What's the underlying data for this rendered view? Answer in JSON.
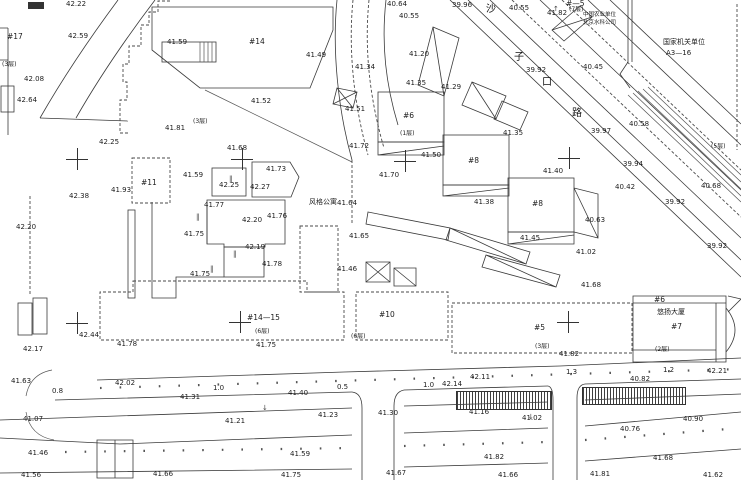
{
  "meta": {
    "app": "cadastral-survey-map",
    "background": "#ffffff",
    "ink_color": "#1c1c1c",
    "canvas": {
      "width": 741,
      "height": 480
    }
  },
  "map": {
    "street_name_chars": [
      "沙",
      "子",
      "口",
      "路"
    ],
    "labels": [
      {
        "t": "42.22",
        "x": 66,
        "y": 1
      },
      {
        "t": "42.59",
        "x": 68,
        "y": 33
      },
      {
        "t": "42.08",
        "x": 24,
        "y": 76
      },
      {
        "t": "42.64",
        "x": 17,
        "y": 97
      },
      {
        "t": "42.25",
        "x": 99,
        "y": 139
      },
      {
        "t": "41.59",
        "x": 167,
        "y": 39
      },
      {
        "t": "41.81",
        "x": 165,
        "y": 125
      },
      {
        "t": "41.68",
        "x": 227,
        "y": 145
      },
      {
        "t": "41.73",
        "x": 266,
        "y": 166
      },
      {
        "t": "41.49",
        "x": 306,
        "y": 52
      },
      {
        "t": "41.52",
        "x": 251,
        "y": 98
      },
      {
        "t": "41.51",
        "x": 345,
        "y": 106
      },
      {
        "t": "41.20",
        "x": 409,
        "y": 51
      },
      {
        "t": "40.64",
        "x": 387,
        "y": 1
      },
      {
        "t": "40.55",
        "x": 399,
        "y": 13
      },
      {
        "t": "39.96",
        "x": 452,
        "y": 2
      },
      {
        "t": "41.34",
        "x": 355,
        "y": 64
      },
      {
        "t": "40.55",
        "x": 509,
        "y": 5
      },
      {
        "t": "41.82",
        "x": 547,
        "y": 10
      },
      {
        "t": "39.92",
        "x": 526,
        "y": 67
      },
      {
        "t": "40.45",
        "x": 583,
        "y": 64
      },
      {
        "t": "40.58",
        "x": 629,
        "y": 121
      },
      {
        "t": "39.97",
        "x": 591,
        "y": 128
      },
      {
        "t": "39.94",
        "x": 623,
        "y": 161
      },
      {
        "t": "40.42",
        "x": 615,
        "y": 184
      },
      {
        "t": "40.68",
        "x": 701,
        "y": 183
      },
      {
        "t": "39.92",
        "x": 665,
        "y": 199
      },
      {
        "t": "39.92",
        "x": 707,
        "y": 243
      },
      {
        "t": "40.63",
        "x": 585,
        "y": 217
      },
      {
        "t": "41.35",
        "x": 406,
        "y": 80
      },
      {
        "t": "41.29",
        "x": 441,
        "y": 84
      },
      {
        "t": "41.35",
        "x": 503,
        "y": 130
      },
      {
        "t": "41.50",
        "x": 421,
        "y": 152
      },
      {
        "t": "41.70",
        "x": 379,
        "y": 172
      },
      {
        "t": "41.40",
        "x": 543,
        "y": 168
      },
      {
        "t": "41.38",
        "x": 474,
        "y": 199
      },
      {
        "t": "41.45",
        "x": 520,
        "y": 235
      },
      {
        "t": "41.02",
        "x": 576,
        "y": 249
      },
      {
        "t": "41.68",
        "x": 581,
        "y": 282
      },
      {
        "t": "41.72",
        "x": 349,
        "y": 143
      },
      {
        "t": "41.93",
        "x": 111,
        "y": 187
      },
      {
        "t": "42.38",
        "x": 69,
        "y": 193
      },
      {
        "t": "42.20",
        "x": 16,
        "y": 224
      },
      {
        "t": "41.59",
        "x": 183,
        "y": 172
      },
      {
        "t": "42.25",
        "x": 219,
        "y": 182
      },
      {
        "t": "42.27",
        "x": 250,
        "y": 184
      },
      {
        "t": "41.77",
        "x": 204,
        "y": 202
      },
      {
        "t": "42.20",
        "x": 242,
        "y": 217
      },
      {
        "t": "41.76",
        "x": 267,
        "y": 213
      },
      {
        "t": "41.75",
        "x": 184,
        "y": 231
      },
      {
        "t": "42.19",
        "x": 245,
        "y": 244
      },
      {
        "t": "41.78",
        "x": 262,
        "y": 261
      },
      {
        "t": "41.75",
        "x": 190,
        "y": 271
      },
      {
        "t": "41.64",
        "x": 337,
        "y": 200
      },
      {
        "t": "41.65",
        "x": 349,
        "y": 233
      },
      {
        "t": "41.46",
        "x": 337,
        "y": 266
      },
      {
        "t": "41.75",
        "x": 256,
        "y": 342
      },
      {
        "t": "41.78",
        "x": 117,
        "y": 341
      },
      {
        "t": "42.44",
        "x": 79,
        "y": 332
      },
      {
        "t": "42.17",
        "x": 23,
        "y": 346
      },
      {
        "t": "41.63",
        "x": 11,
        "y": 378
      },
      {
        "t": "42.02",
        "x": 115,
        "y": 380
      },
      {
        "t": "41.40",
        "x": 288,
        "y": 390
      },
      {
        "t": "41.31",
        "x": 180,
        "y": 394
      },
      {
        "t": "41.21",
        "x": 225,
        "y": 418
      },
      {
        "t": "41.23",
        "x": 318,
        "y": 412
      },
      {
        "t": "41.30",
        "x": 378,
        "y": 410
      },
      {
        "t": "41.07",
        "x": 23,
        "y": 416
      },
      {
        "t": "41.46",
        "x": 28,
        "y": 450
      },
      {
        "t": "41.59",
        "x": 290,
        "y": 451
      },
      {
        "t": "41.56",
        "x": 21,
        "y": 472
      },
      {
        "t": "41.66",
        "x": 153,
        "y": 471
      },
      {
        "t": "41.75",
        "x": 281,
        "y": 472
      },
      {
        "t": "41.67",
        "x": 386,
        "y": 470
      },
      {
        "t": "42.14",
        "x": 442,
        "y": 381
      },
      {
        "t": "42.11",
        "x": 470,
        "y": 374
      },
      {
        "t": "40.82",
        "x": 630,
        "y": 376
      },
      {
        "t": "42.21",
        "x": 707,
        "y": 368
      },
      {
        "t": "41.16",
        "x": 469,
        "y": 409
      },
      {
        "t": "41.02",
        "x": 522,
        "y": 415
      },
      {
        "t": "40.76",
        "x": 620,
        "y": 426
      },
      {
        "t": "40.90",
        "x": 683,
        "y": 416
      },
      {
        "t": "41.82",
        "x": 484,
        "y": 454
      },
      {
        "t": "41.68",
        "x": 653,
        "y": 455
      },
      {
        "t": "41.66",
        "x": 498,
        "y": 472
      },
      {
        "t": "41.81",
        "x": 590,
        "y": 471
      },
      {
        "t": "41.62",
        "x": 703,
        "y": 472
      },
      {
        "t": "41.82",
        "x": 559,
        "y": 351
      },
      {
        "t": "0.8",
        "x": 52,
        "y": 388,
        "cls": "dim"
      },
      {
        "t": "1.0",
        "x": 213,
        "y": 385,
        "cls": "dim"
      },
      {
        "t": "0.5",
        "x": 337,
        "y": 384,
        "cls": "dim"
      },
      {
        "t": "1.0",
        "x": 423,
        "y": 382,
        "cls": "dim"
      },
      {
        "t": "1.3",
        "x": 566,
        "y": 369,
        "cls": "dim"
      },
      {
        "t": "1.2",
        "x": 663,
        "y": 367,
        "cls": "dim"
      },
      {
        "t": "#17",
        "x": 7,
        "y": 33,
        "cls": "bld"
      },
      {
        "t": "#14",
        "x": 249,
        "y": 38,
        "cls": "bld"
      },
      {
        "t": "#11",
        "x": 141,
        "y": 179,
        "cls": "bld"
      },
      {
        "t": "#6",
        "x": 403,
        "y": 112,
        "cls": "bld"
      },
      {
        "t": "#8",
        "x": 468,
        "y": 157,
        "cls": "bld"
      },
      {
        "t": "#8",
        "x": 532,
        "y": 200,
        "cls": "bld"
      },
      {
        "t": "#14—15",
        "x": 247,
        "y": 314,
        "cls": "bld"
      },
      {
        "t": "#10",
        "x": 379,
        "y": 311,
        "cls": "bld"
      },
      {
        "t": "#5",
        "x": 534,
        "y": 324,
        "cls": "bld"
      },
      {
        "t": "#7",
        "x": 671,
        "y": 323,
        "cls": "bld"
      },
      {
        "t": "#6",
        "x": 654,
        "y": 296,
        "cls": "bld"
      },
      {
        "t": "#—5",
        "x": 566,
        "y": 0,
        "cls": "bld"
      },
      {
        "t": "(3层)",
        "x": 2,
        "y": 62,
        "cls": "floor"
      },
      {
        "t": "(3层)",
        "x": 193,
        "y": 119,
        "cls": "floor"
      },
      {
        "t": "(1层)",
        "x": 400,
        "y": 131,
        "cls": "floor"
      },
      {
        "t": "(6层)",
        "x": 255,
        "y": 329,
        "cls": "floor"
      },
      {
        "t": "(6层)",
        "x": 351,
        "y": 334,
        "cls": "floor"
      },
      {
        "t": "(3层)",
        "x": 535,
        "y": 344,
        "cls": "floor"
      },
      {
        "t": "(2层)",
        "x": 655,
        "y": 347,
        "cls": "floor"
      },
      {
        "t": "(7层)",
        "x": 569,
        "y": 7,
        "cls": "floor"
      },
      {
        "t": "(5层)",
        "x": 711,
        "y": 144,
        "cls": "floor"
      },
      {
        "t": "悠扬大厦",
        "x": 657,
        "y": 309,
        "cls": "name"
      },
      {
        "t": "风格公寓",
        "x": 309,
        "y": 199,
        "cls": "name"
      },
      {
        "t": "国家机关单位",
        "x": 663,
        "y": 39,
        "cls": "name"
      },
      {
        "t": "A3—16",
        "x": 666,
        "y": 50,
        "cls": "name"
      },
      {
        "t": "中国农业单位",
        "x": 583,
        "y": 13,
        "cls": "tiny"
      },
      {
        "t": "北京水科公司",
        "x": 583,
        "y": 21,
        "cls": "tiny"
      },
      {
        "t": "沙",
        "x": 486,
        "y": 5,
        "cls": "street"
      },
      {
        "t": "子",
        "x": 514,
        "y": 53,
        "cls": "street"
      },
      {
        "t": "口",
        "x": 542,
        "y": 78,
        "cls": "street"
      },
      {
        "t": "路",
        "x": 572,
        "y": 109,
        "cls": "street"
      },
      {
        "t": "↓",
        "x": 262,
        "y": 405,
        "cls": "sym"
      },
      {
        "t": "↓",
        "x": 528,
        "y": 414,
        "cls": "sym"
      },
      {
        "t": "↑",
        "x": 553,
        "y": 6,
        "cls": "sym"
      },
      {
        "t": "‖",
        "x": 229,
        "y": 176,
        "cls": "sym"
      },
      {
        "t": "‖",
        "x": 196,
        "y": 214,
        "cls": "sym"
      },
      {
        "t": "‖",
        "x": 233,
        "y": 251,
        "cls": "sym"
      },
      {
        "t": "‖",
        "x": 210,
        "y": 266,
        "cls": "sym"
      }
    ],
    "crosses": [
      {
        "x": 77,
        "y": 159
      },
      {
        "x": 242,
        "y": 159
      },
      {
        "x": 405,
        "y": 161
      },
      {
        "x": 569,
        "y": 158
      },
      {
        "x": 77,
        "y": 323
      },
      {
        "x": 240,
        "y": 322
      },
      {
        "x": 568,
        "y": 322
      }
    ],
    "hatch_walls": [
      {
        "x": 456,
        "y": 391,
        "w": 94,
        "h": 17
      },
      {
        "x": 582,
        "y": 387,
        "w": 102,
        "h": 16
      }
    ]
  }
}
